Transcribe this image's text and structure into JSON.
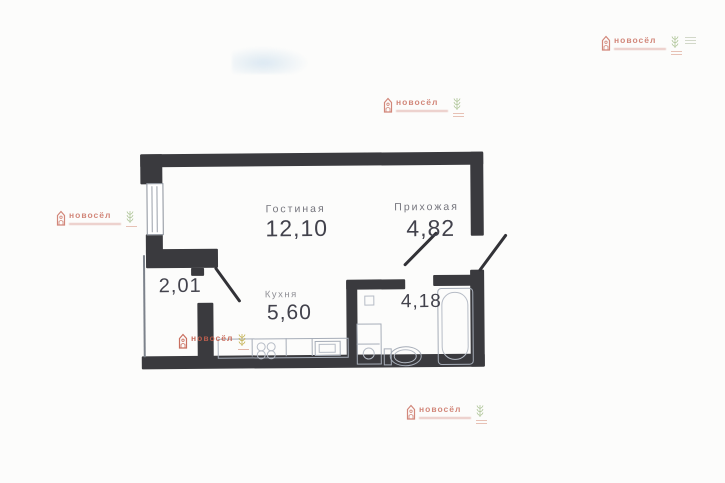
{
  "document": {
    "type": "scanned apartment floor plan",
    "background_color": "#fcfcfb",
    "wall_color": "#3a3a3e"
  },
  "watermark": {
    "brand": "новосёл",
    "brand_color": "#c4604f",
    "sprig_green": "#96b478",
    "sprig_yellow": "#bda93f",
    "icons": [
      "house-logo-icon",
      "laurel-sprig-icon"
    ]
  },
  "floorplan": {
    "rooms": {
      "living": {
        "name": "Гостиная",
        "area": "12,10"
      },
      "hallway": {
        "name": "Прихожая",
        "area": "4,82"
      },
      "kitchen": {
        "name": "Кухня",
        "area": "5,60"
      },
      "balcony": {
        "area": "2,01"
      },
      "bathroom": {
        "area": "4,18"
      }
    }
  }
}
